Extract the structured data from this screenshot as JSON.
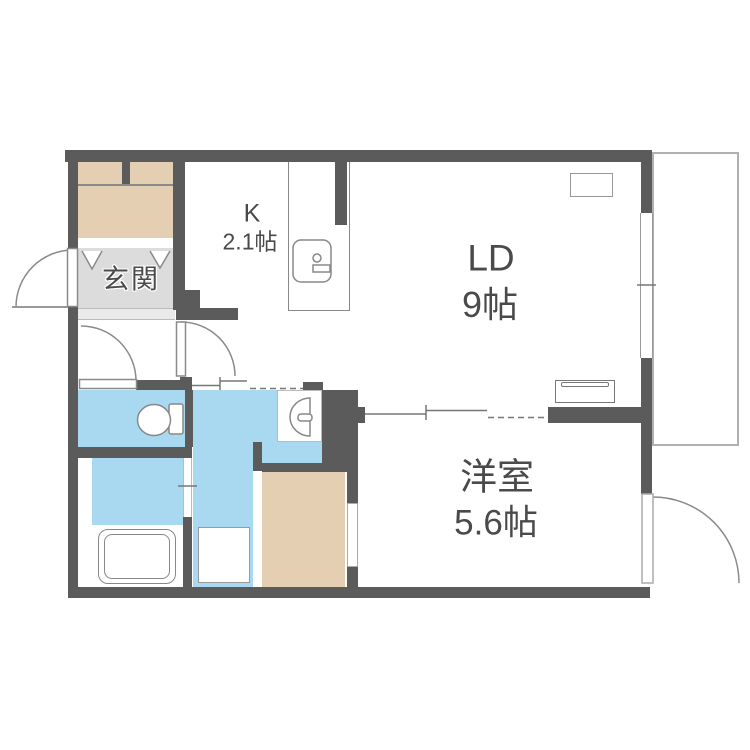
{
  "plan": {
    "rooms": {
      "entrance_label": "玄関",
      "kitchen_abbr": "K",
      "kitchen_size": "2.1帖",
      "living_abbr": "LD",
      "living_size": "9帖",
      "bedroom_name": "洋室",
      "bedroom_size": "5.6帖"
    },
    "colors": {
      "wall": "#5b5b5b",
      "water_area": "#a9d9f1",
      "closet": "#e5cfb2",
      "entrance_floor": "#dcdcdc",
      "entrance_step": "#eaeaea",
      "line": "#8a8a8a",
      "text": "#4a4a4a"
    }
  }
}
